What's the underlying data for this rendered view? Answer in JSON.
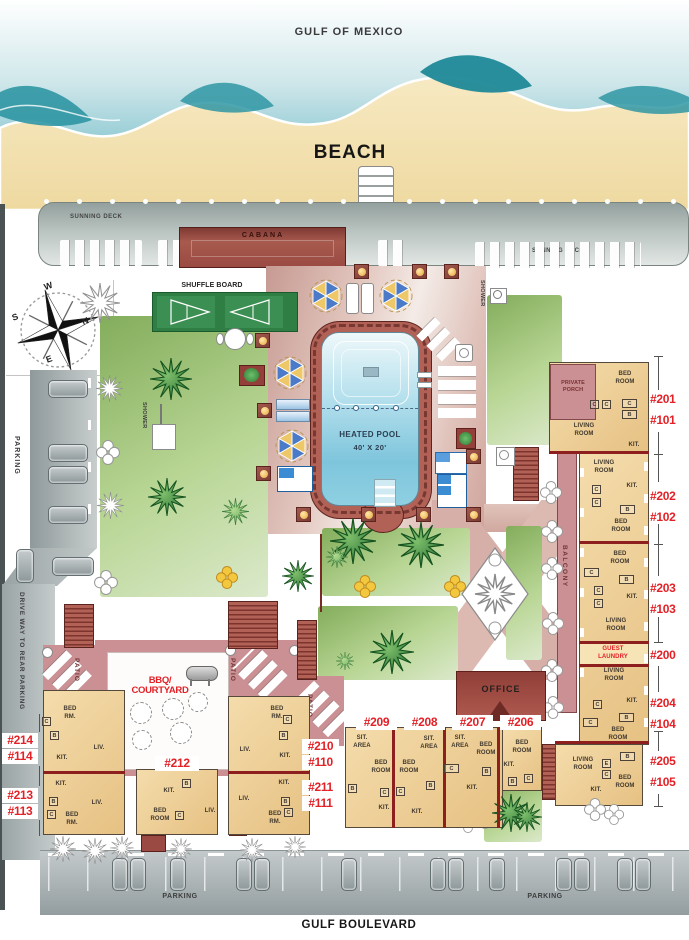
{
  "labels": {
    "gulf_of_mexico": "GULF OF MEXICO",
    "beach": "BEACH",
    "sunning_deck": "SUNNING DECK",
    "cabana": "CABANA",
    "shuffle_board": "SHUFFLE BOARD",
    "heated_pool_1": "HEATED POOL",
    "heated_pool_2": "40' X 20'",
    "shower": "SHOWER",
    "balcony": "BALCONY",
    "private_porch_1": "PRIVATE",
    "private_porch_2": "PORCH",
    "guest_laundry_1": "GUEST",
    "guest_laundry_2": "LAUNDRY",
    "office": "OFFICE",
    "bbq_1": "BBQ/",
    "bbq_2": "COURTYARD",
    "patio": "PATIO",
    "parking": "PARKING",
    "driveway": "DRIVE WAY TO REAR PARKING",
    "gulf_boulevard": "GULF BOULEVARD"
  },
  "compass": {
    "w": "W",
    "n": "N",
    "s": "S",
    "e": "E"
  },
  "units": {
    "201": "#201",
    "101": "#101",
    "202": "#202",
    "102": "#102",
    "203": "#203",
    "103": "#103",
    "200": "#200",
    "204": "#204",
    "104": "#104",
    "205": "#205",
    "105": "#105",
    "206": "#206",
    "207": "#207",
    "208": "#208",
    "209": "#209",
    "210": "#210",
    "110": "#110",
    "211": "#211",
    "111": "#111",
    "212": "#212",
    "213": "#213",
    "113": "#113",
    "214": "#214",
    "114": "#114"
  },
  "words": {
    "bed": "BED",
    "room": "ROOM",
    "rm": "RM.",
    "living": "LIVING",
    "liv": "LIV.",
    "kit": "KIT.",
    "sit": "SIT.",
    "area": "AREA",
    "b": "B",
    "c": "C",
    "e": "E"
  },
  "colors": {
    "unit_number_red": "#e32127",
    "roof_red": "#9a4a42",
    "building_tan": "#ecc88f",
    "deck_pink": "#c79a92",
    "pool_blue": "#8fd0e2",
    "lawn_green": "#8fb768"
  }
}
